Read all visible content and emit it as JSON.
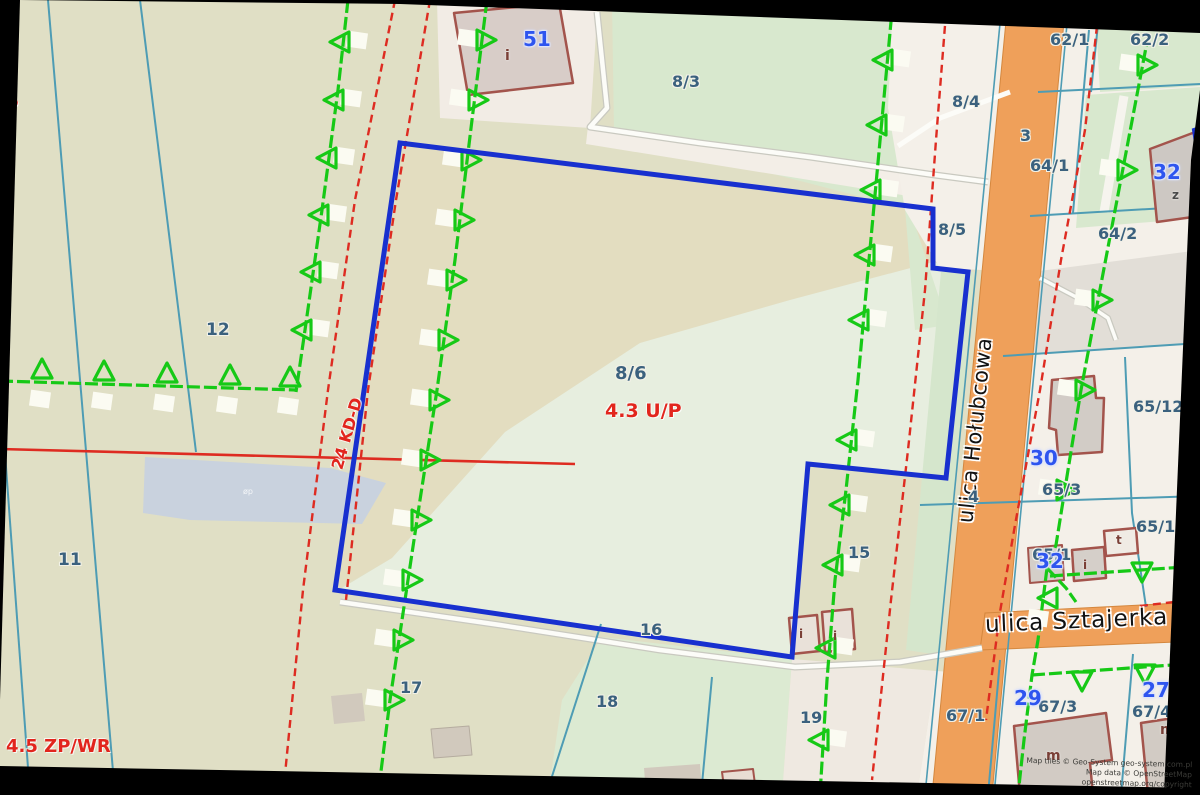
{
  "map": {
    "zones": {
      "left_partial": "U/P",
      "zp_wr": "4.5 ZP/WR",
      "up_main": "4.3 U/P",
      "road_class": "24 KD-D"
    },
    "streets": {
      "holubcowa": "ulica Hołubcowa",
      "sztajerka": "ulica Sztajerka"
    },
    "parcels": {
      "p8_3": "8/3",
      "p8_4": "8/4",
      "p8_5": "8/5",
      "p8_6": "8/6",
      "p62_1": "62/1",
      "p62_2": "62/2",
      "p3": "3",
      "p64_1": "64/1",
      "p64_2": "64/2",
      "p65_12": "65/12",
      "p65_3": "65/3",
      "p65_11": "65/11",
      "p65_1": "65/1",
      "p4": "4",
      "p12": "12",
      "p11": "11",
      "p15": "15",
      "p16": "16",
      "p17": "17",
      "p18": "18",
      "p19": "19",
      "p67_1": "67/1",
      "p67_3": "67/3",
      "p67_4": "67/4"
    },
    "building_numbers": {
      "n51": "51",
      "n32_north": "32",
      "n30": "30",
      "n32_south": "32",
      "n29": "29",
      "n27": "27"
    },
    "building_letters": {
      "z": "z",
      "t": "t",
      "i_51": "i",
      "i_a": "i",
      "i_b": "i",
      "i_c": "i",
      "m_a": "m",
      "m_b": "m"
    },
    "pond_label": "øp",
    "attribution": {
      "line1": "Map tiles © Geo-System geo-system.com.pl",
      "line2": "Map data © OpenStreetMap openstreetmap.org/copyright"
    },
    "colors": {
      "selection_blue": "#1830cf",
      "road_orange": "#efa05a",
      "zone_boundary_green": "#16c916",
      "zone_red": "#e2251d",
      "parcel_line_teal": "#4e9cb4",
      "parcel_number": "#3b617e",
      "building_number_blue": "#2e55ef",
      "water": "#c9d2de"
    }
  }
}
